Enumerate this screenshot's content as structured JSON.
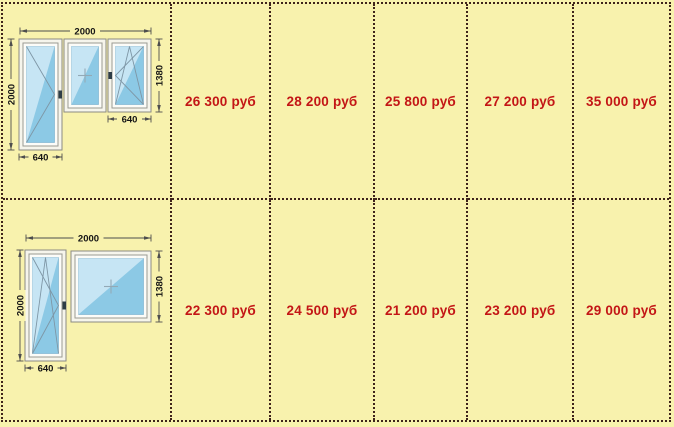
{
  "table": {
    "currency_note": "руб",
    "colors": {
      "background": "#F8F2AD",
      "border_dotted": "#3F241B",
      "price_text": "#C31616",
      "glass_blue": "#8CC9E5"
    },
    "rows": [
      {
        "diagram": {
          "kind": "balcony-block-door-plus-two-windows",
          "total_width": "2000",
          "door_height": "2000",
          "window_height": "1380",
          "window_width": "640",
          "door_width": "640"
        },
        "prices": [
          "26 300 руб",
          "28 200 руб",
          "25 800 руб",
          "27 200 руб",
          "35 000 руб"
        ]
      },
      {
        "diagram": {
          "kind": "balcony-block-door-plus-one-window",
          "total_width": "2000",
          "door_height": "2000",
          "window_height": "1380",
          "door_width": "640"
        },
        "prices": [
          "22 300 руб",
          "24 500 руб",
          "21 200 руб",
          "23 200 руб",
          "29 000 руб"
        ]
      }
    ]
  }
}
